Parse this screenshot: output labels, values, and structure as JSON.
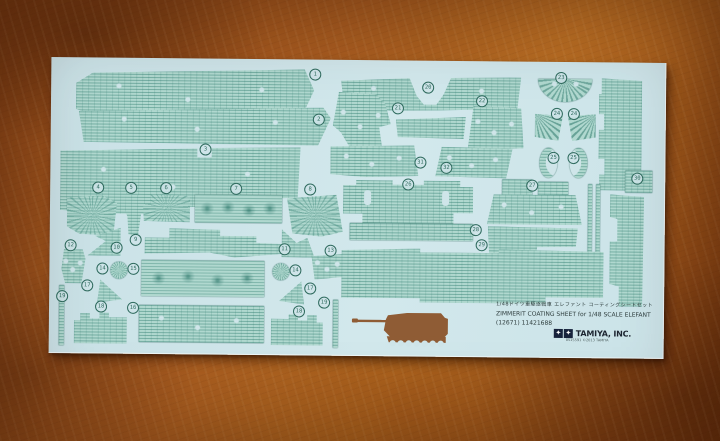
{
  "background": {
    "surface": "mottled copper-brown leather texture",
    "base_color": "#a4591e"
  },
  "sheet": {
    "paper_color": "#cfe5e9",
    "piece_color": "#b0d8cf",
    "line_color": "#2f6b5e",
    "title_ja": "1/48ドイツ重駆逐戦車 エレファント コーティングシートセット",
    "title_en": "ZIMMERIT COATING SHEET for 1/48 SCALE ELEFANT",
    "item_code": "(12671) 11421688",
    "brand": "TAMIYA, INC.",
    "brand_code": "0515591",
    "copyright": "©2013 TAMIYA",
    "logo_star": "✦",
    "tank_color": "#8f5c35"
  },
  "pieces": [
    {
      "cls": "zim holes",
      "x": 25,
      "y": 10,
      "w": 238,
      "h": 52,
      "clip": "polygon(0% 30%, 7% 10%, 96% 0%, 100% 40%, 94% 100%, 9% 95%, 0% 80%)"
    },
    {
      "cls": "zim holes",
      "x": 28,
      "y": 48,
      "w": 252,
      "h": 38,
      "clip": "polygon(0% 15%, 97% 0%, 100% 28%, 95% 100%, 2% 96%)"
    },
    {
      "cls": "zim holes",
      "x": 10,
      "y": 88,
      "w": 240,
      "h": 68,
      "clip": "polygon(0% 8%, 57% 3%, 57% 16%, 63% 16%, 63% 2%, 100% 0%, 99% 74%, 76% 77%, 76% 88%, 40% 90%, 40% 100%, 12% 100%, 0% 95%)"
    },
    {
      "cls": "zim burst",
      "x": 17,
      "y": 138,
      "w": 50,
      "h": 40,
      "clip": "polygon(0% 6%, 70% 0%, 100% 18%, 93% 100%, 25% 96%, 0% 78%)"
    },
    {
      "cls": "zim",
      "x": 75,
      "y": 136,
      "w": 17,
      "h": 42,
      "clip": "polygon(5% 0%, 100% 4%, 80% 30%, 95% 48%, 78% 100%, 22% 97%, 15% 55%, 0% 38%)"
    },
    {
      "cls": "zim burst",
      "x": 93,
      "y": 136,
      "w": 47,
      "h": 28,
      "clip": "polygon(16% 0%, 100% 6%, 100% 100%, 2% 96%, 0% 36%, 16% 36%)"
    },
    {
      "cls": "zim daisy",
      "x": 145,
      "y": 136,
      "w": 87,
      "h": 28
    },
    {
      "cls": "zim burst",
      "x": 237,
      "y": 135,
      "w": 56,
      "h": 42,
      "clip": "polygon(0% 10%, 88% 0%, 100% 88%, 62% 100%, 10% 93%)"
    },
    {
      "cls": "zim",
      "x": 95,
      "y": 170,
      "w": 145,
      "h": 30,
      "clip": "polygon(0% 32%, 17% 32%, 17% 0%, 52% 4%, 52% 24%, 77% 24%, 77% 46%, 100% 50%, 100% 80%, 62% 96%, 45% 80%, 0% 85%)"
    },
    {
      "cls": "zim",
      "x": 38,
      "y": 170,
      "w": 33,
      "h": 28,
      "clip": "polygon(100% 0%, 100% 100%, 0% 100%, 55% 48%, 22% 30%)"
    },
    {
      "cls": "zim",
      "x": 232,
      "y": 170,
      "w": 33,
      "h": 28,
      "clip": "polygon(0% 0%, 45% 48%, 78% 30%, 100% 100%, 0% 100%)"
    },
    {
      "cls": "zim holes",
      "x": 12,
      "y": 192,
      "w": 24,
      "h": 34,
      "clip": "polygon(10% 0%, 88% 0%, 100% 28%, 84% 100%, 16% 100%, 0% 58%)"
    },
    {
      "cls": "zim holes",
      "x": 262,
      "y": 194,
      "w": 33,
      "h": 26,
      "clip": "polygon(0% 10%, 100% 0%, 100% 88%, 10% 100%)"
    },
    {
      "cls": "circle",
      "x": 61,
      "y": 204,
      "w": 17,
      "h": 17
    },
    {
      "cls": "circle",
      "x": 223,
      "y": 204,
      "w": 17,
      "h": 17
    },
    {
      "cls": "zim daisy",
      "x": 92,
      "y": 202,
      "w": 123,
      "h": 36
    },
    {
      "cls": "zim holes",
      "x": 90,
      "y": 247,
      "w": 125,
      "h": 37
    },
    {
      "cls": "zim",
      "x": 48,
      "y": 222,
      "w": 25,
      "h": 23,
      "clip": "polygon(12% 0%, 100% 86%, 0% 100%)"
    },
    {
      "cls": "zim",
      "x": 230,
      "y": 222,
      "w": 25,
      "h": 23,
      "clip": "polygon(88% 0%, 100% 100%, 0% 86%)"
    },
    {
      "cls": "zim",
      "x": 25,
      "y": 253,
      "w": 53,
      "h": 33,
      "clip": "polygon(0% 30%, 12% 30%, 12% 8%, 30% 8%, 30% 24%, 48% 24%, 48% 6%, 66% 6%, 66% 20%, 100% 20%, 100% 100%, 0% 100%)"
    },
    {
      "cls": "zim",
      "x": 222,
      "y": 253,
      "w": 52,
      "h": 33,
      "clip": "polygon(0% 20%, 34% 20%, 34% 6%, 52% 6%, 52% 24%, 70% 24%, 70% 8%, 88% 8%, 88% 30%, 100% 30%, 100% 100%, 0% 100%)"
    },
    {
      "cls": "zim",
      "x": 10,
      "y": 228,
      "w": 5,
      "h": 60
    },
    {
      "cls": "zim",
      "x": 284,
      "y": 240,
      "w": 5,
      "h": 48
    },
    {
      "cls": "zim holes",
      "x": 290,
      "y": 16,
      "w": 180,
      "h": 35,
      "clip": "polygon(0% 14%, 38% 5%, 42% 55%, 46% 80%, 53% 80%, 57% 50%, 61% 3%, 100% 0%, 98% 90%, 55% 96%, 2% 100%)"
    },
    {
      "cls": "zim holes",
      "x": 282,
      "y": 32,
      "w": 58,
      "h": 58,
      "clip": "polygon(10% 0%, 74% 4%, 90% 20%, 100% 55%, 80% 60%, 86% 100%, 30% 96%, 14% 70%, 0% 58%, 6% 24%)"
    },
    {
      "cls": "zim",
      "x": 345,
      "y": 56,
      "w": 70,
      "h": 22,
      "clip": "polygon(0% 15%, 100% 0%, 97% 100%, 3% 94%)"
    },
    {
      "cls": "zim holes",
      "x": 417,
      "y": 45,
      "w": 56,
      "h": 44,
      "clip": "polygon(10% 0%, 95% 4%, 100% 95%, 0% 100%, 6% 40%)"
    },
    {
      "cls": "zim holes",
      "x": 280,
      "y": 85,
      "w": 88,
      "h": 32,
      "clip": "polygon(0% 5%, 95% 0%, 100% 95%, 40% 100%, 0% 92%)"
    },
    {
      "cls": "zim holes",
      "x": 385,
      "y": 86,
      "w": 77,
      "h": 31,
      "clip": "polygon(8% 0%, 100% 5%, 92% 100%, 0% 95%)"
    },
    {
      "cls": "semi",
      "x": 487,
      "y": 17,
      "w": 54,
      "h": 23
    },
    {
      "cls": "fan-l",
      "x": 484,
      "y": 52,
      "w": 28,
      "h": 27,
      "clip": "polygon(0% 0%, 100% 8%, 84% 100%, 0% 86%)"
    },
    {
      "cls": "fan-r",
      "x": 517,
      "y": 52,
      "w": 28,
      "h": 27,
      "clip": "polygon(0% 8%, 100% 0%, 100% 86%, 16% 100%)"
    },
    {
      "cls": "crescent-l",
      "x": 489,
      "y": 86,
      "w": 18,
      "h": 30
    },
    {
      "cls": "crescent-r",
      "x": 519,
      "y": 86,
      "w": 18,
      "h": 30
    },
    {
      "cls": "zim",
      "x": 548,
      "y": 16,
      "w": 43,
      "h": 112,
      "clip": "polygon(6% 0%, 100% 2%, 100% 100%, 2% 100%, 2% 86%, 14% 86%, 14% 72%, 0% 72%, 0% 46%, 12% 46%, 12% 32%, 0% 32%, 0% 14%, 6% 14%)"
    },
    {
      "cls": "zim",
      "x": 575,
      "y": 108,
      "w": 27,
      "h": 22
    },
    {
      "cls": "zim",
      "x": 560,
      "y": 132,
      "w": 34,
      "h": 112,
      "clip": "polygon(0% 0%, 100% 2%, 97% 100%, 28% 100%, 28% 82%, 0% 80%, 0% 42%, 22% 42%, 22% 22%, 0% 20%)"
    },
    {
      "cls": "zim slots",
      "x": 293,
      "y": 120,
      "w": 130,
      "h": 43,
      "clip": "polygon(0% 12%, 10% 12%, 10% 0%, 38% 0%, 38% 10%, 62% 10%, 62% 0%, 90% 0%, 90% 14%, 100% 14%, 100% 75%, 85% 75%, 85% 100%, 15% 100%, 15% 78%, 0% 78%)"
    },
    {
      "cls": "zim",
      "x": 452,
      "y": 118,
      "w": 30,
      "h": 17
    },
    {
      "cls": "zim",
      "x": 488,
      "y": 120,
      "w": 30,
      "h": 17
    },
    {
      "cls": "zim holes",
      "x": 437,
      "y": 133,
      "w": 95,
      "h": 30,
      "clip": "polygon(7% 0%, 93% 0%, 100% 100%, 0% 100%)"
    },
    {
      "cls": "zim",
      "x": 300,
      "y": 163,
      "w": 123,
      "h": 17
    },
    {
      "cls": "zim",
      "x": 438,
      "y": 165,
      "w": 90,
      "h": 34,
      "clip": "polygon(0% 0%, 100% 4%, 98% 58%, 55% 60%, 53% 100%, 2% 96%)"
    },
    {
      "cls": "zim",
      "x": 538,
      "y": 122,
      "w": 4,
      "h": 70
    },
    {
      "cls": "zim",
      "x": 546,
      "y": 122,
      "w": 4,
      "h": 70
    },
    {
      "cls": "zim",
      "x": 292,
      "y": 188,
      "w": 262,
      "h": 54,
      "clip": "polygon(0% 4%, 30% 0%, 30% 7%, 60% 7%, 60% 0%, 100% 3%, 100% 88%, 78% 88%, 78% 100%, 30% 100%, 30% 92%, 0% 92%)"
    }
  ],
  "part_numbers": [
    {
      "n": "1",
      "x": 264,
      "y": 15
    },
    {
      "n": "2",
      "x": 268,
      "y": 60
    },
    {
      "n": "3",
      "x": 155,
      "y": 91
    },
    {
      "n": "4",
      "x": 48,
      "y": 130
    },
    {
      "n": "5",
      "x": 81,
      "y": 130
    },
    {
      "n": "6",
      "x": 116,
      "y": 130
    },
    {
      "n": "7",
      "x": 186,
      "y": 130
    },
    {
      "n": "8",
      "x": 260,
      "y": 130
    },
    {
      "n": "9",
      "x": 86,
      "y": 182
    },
    {
      "n": "10",
      "x": 67,
      "y": 190
    },
    {
      "n": "11",
      "x": 235,
      "y": 190
    },
    {
      "n": "12",
      "x": 21,
      "y": 188
    },
    {
      "n": "13",
      "x": 281,
      "y": 191
    },
    {
      "n": "14",
      "x": 53,
      "y": 211
    },
    {
      "n": "14",
      "x": 246,
      "y": 211
    },
    {
      "n": "15",
      "x": 84,
      "y": 211
    },
    {
      "n": "16",
      "x": 84,
      "y": 250
    },
    {
      "n": "17",
      "x": 38,
      "y": 228
    },
    {
      "n": "17",
      "x": 261,
      "y": 229
    },
    {
      "n": "18",
      "x": 52,
      "y": 249
    },
    {
      "n": "18",
      "x": 250,
      "y": 252
    },
    {
      "n": "19",
      "x": 13,
      "y": 239
    },
    {
      "n": "19",
      "x": 275,
      "y": 243
    },
    {
      "n": "20",
      "x": 377,
      "y": 27
    },
    {
      "n": "21",
      "x": 347,
      "y": 48
    },
    {
      "n": "22",
      "x": 431,
      "y": 40
    },
    {
      "n": "23",
      "x": 510,
      "y": 16
    },
    {
      "n": "24",
      "x": 506,
      "y": 52
    },
    {
      "n": "24",
      "x": 523,
      "y": 52
    },
    {
      "n": "25",
      "x": 503,
      "y": 96
    },
    {
      "n": "25",
      "x": 523,
      "y": 96
    },
    {
      "n": "26",
      "x": 358,
      "y": 124
    },
    {
      "n": "27",
      "x": 482,
      "y": 124
    },
    {
      "n": "28",
      "x": 426,
      "y": 169
    },
    {
      "n": "29",
      "x": 432,
      "y": 184
    },
    {
      "n": "30",
      "x": 587,
      "y": 116
    },
    {
      "n": "31",
      "x": 370,
      "y": 102
    },
    {
      "n": "32",
      "x": 396,
      "y": 107
    }
  ]
}
